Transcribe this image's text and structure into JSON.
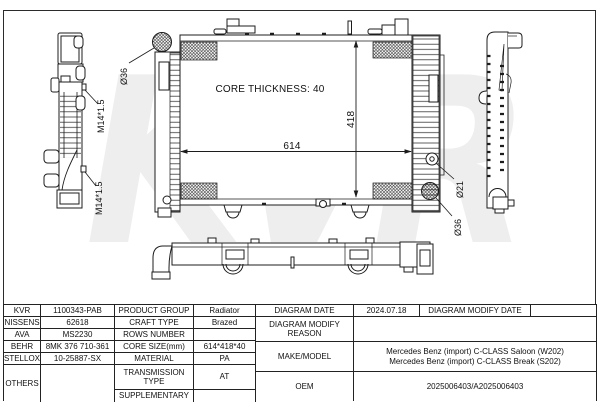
{
  "sheet": {
    "watermark": "KVR",
    "drawing": {
      "core_thickness": "CORE THICKNESS: 40",
      "dim_core_width": "614",
      "dim_core_height": "418",
      "label_inlet_top": "Ø36",
      "label_port_top": "M14*1.5",
      "label_port_bottom": "M14*1.5",
      "label_pipe_small": "Ø21",
      "label_outlet_bottom": "Ø36"
    },
    "table": {
      "rows": [
        {
          "brand": "KVR",
          "code": "1100343-PAB",
          "spec": "PRODUCT GROUP",
          "value": "Radiator"
        },
        {
          "brand": "NISSENS",
          "code": "62618",
          "spec": "CRAFT TYPE",
          "value": "Brazed"
        },
        {
          "brand": "AVA",
          "code": "MS2230",
          "spec": "ROWS NUMBER",
          "value": ""
        },
        {
          "brand": "BEHR",
          "code": "8MK 376 710-361",
          "spec": "CORE SIZE(mm)",
          "value": "614*418*40"
        },
        {
          "brand": "STELLOX",
          "code": "10-25887-SX",
          "spec": "MATERIAL",
          "value": "PA"
        },
        {
          "brand": "OTHERS",
          "code": "",
          "spec": "TRANSMISSION TYPE",
          "value": "AT"
        },
        {
          "spec": "SUPPLEMENTARY",
          "value": ""
        }
      ],
      "right": {
        "diagram_date_label": "DIAGRAM DATE",
        "diagram_date_value": "2024.07.18",
        "diagram_modify_date_label": "DIAGRAM MODIFY DATE",
        "diagram_modify_date_value": "",
        "diagram_modify_reason_label": "DIAGRAM MODIFY REASON",
        "diagram_modify_reason_value": "",
        "make_model_label": "MAKE/MODEL",
        "make_model_line1": "Mercedes Benz (import) C-CLASS Saloon (W202)",
        "make_model_line2": "Mercedes Benz (import) C-CLASS Break (S202)",
        "oem_label": "OEM",
        "oem_value": "2025006403/A2025006403"
      }
    }
  }
}
